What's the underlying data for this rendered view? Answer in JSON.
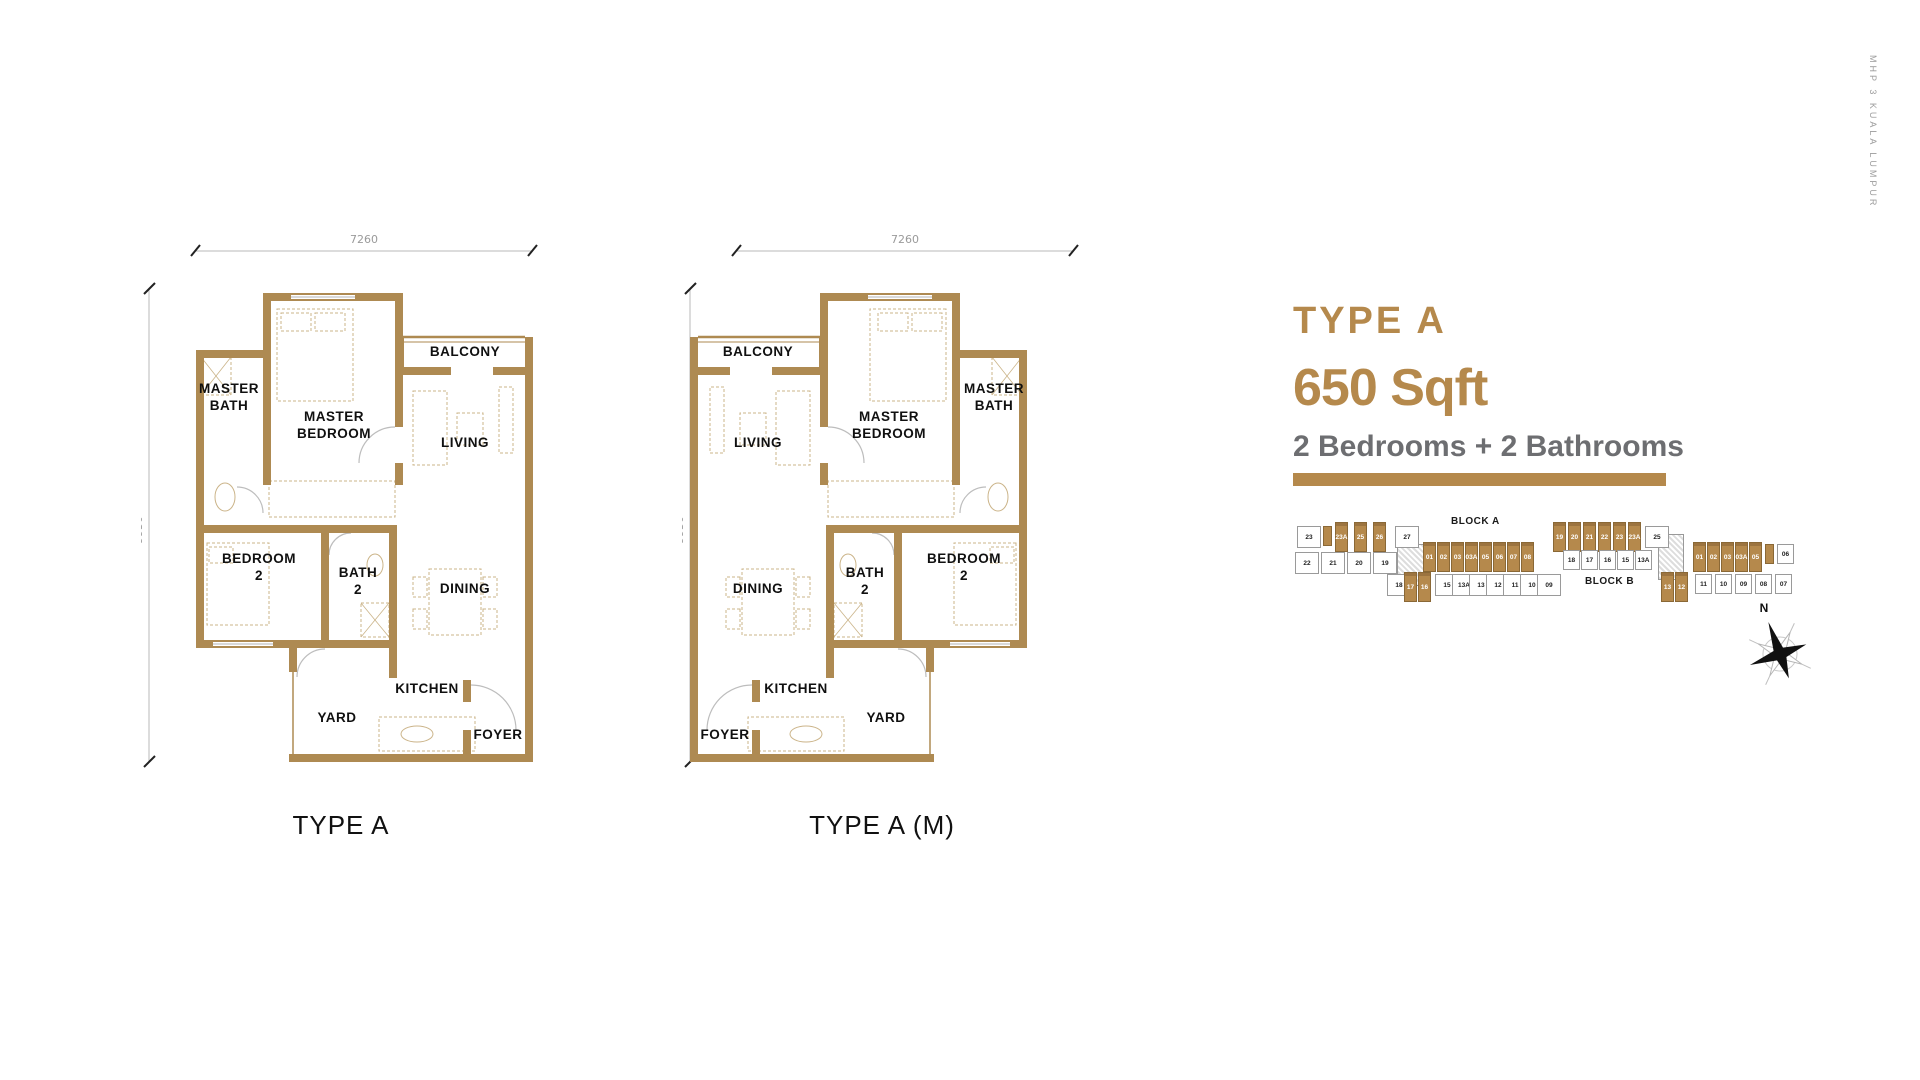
{
  "side_text": "MHP 3 KUALA LUMPUR",
  "info": {
    "title": "TYPE A",
    "size": "650 Sqft",
    "rooms": "2 Bedrooms + 2 Bathrooms",
    "accent_color": "#B5894C",
    "gray_color": "#6D6E71"
  },
  "floorplan": {
    "dim_top": "7260",
    "dim_left": "9950",
    "wall_color": "#AE8A52",
    "furniture_color": "#CBB489",
    "walls": [
      [
        122,
        68,
        140,
        8
      ],
      [
        122,
        68,
        8,
        192
      ],
      [
        254,
        68,
        8,
        134
      ],
      [
        254,
        238,
        8,
        22
      ],
      [
        55,
        125,
        75,
        8
      ],
      [
        55,
        125,
        8,
        183
      ],
      [
        55,
        300,
        133,
        8
      ],
      [
        55,
        308,
        8,
        107
      ],
      [
        55,
        415,
        133,
        8
      ],
      [
        180,
        300,
        8,
        123
      ],
      [
        188,
        300,
        68,
        8
      ],
      [
        248,
        300,
        8,
        123
      ],
      [
        180,
        415,
        76,
        8
      ],
      [
        262,
        142,
        48,
        8
      ],
      [
        352,
        142,
        40,
        8
      ],
      [
        384,
        112,
        8,
        425
      ],
      [
        148,
        529,
        244,
        8
      ],
      [
        148,
        415,
        8,
        32
      ],
      [
        322,
        455,
        8,
        22
      ],
      [
        322,
        505,
        8,
        32
      ],
      [
        248,
        415,
        8,
        38
      ]
    ],
    "windows": [
      [
        150,
        70,
        64,
        4
      ],
      [
        72,
        417,
        60,
        4
      ]
    ],
    "thin_lines": [
      [
        262,
        112,
        384,
        112,
        2.5
      ],
      [
        262,
        117,
        384,
        117,
        1
      ],
      [
        262,
        112,
        262,
        142,
        2
      ],
      [
        152,
        419,
        152,
        529,
        1.5
      ]
    ],
    "arcs": [
      "M 254 202 A 36 36 0 0 0 218 238",
      "M 330 460 A 45 45 0 0 1 375 505",
      "M 188 330 A 22 22 0 0 1 210 308",
      "M 122 288 A 26 26 0 0 0 96 262",
      "M 156 452 A 28 28 0 0 1 184 424"
    ],
    "furniture_rects": [
      [
        136,
        84,
        76,
        92
      ],
      [
        140,
        88,
        30,
        18
      ],
      [
        174,
        88,
        30,
        18
      ],
      [
        128,
        256,
        126,
        36
      ],
      [
        66,
        318,
        62,
        82
      ],
      [
        68,
        322,
        24,
        16
      ],
      [
        288,
        344,
        52,
        66
      ],
      [
        272,
        352,
        14,
        20
      ],
      [
        342,
        352,
        14,
        20
      ],
      [
        272,
        384,
        14,
        20
      ],
      [
        342,
        384,
        14,
        20
      ],
      [
        272,
        166,
        34,
        74
      ],
      [
        316,
        188,
        26,
        32
      ],
      [
        358,
        162,
        14,
        66
      ],
      [
        238,
        492,
        96,
        34
      ],
      [
        60,
        132,
        30,
        38
      ],
      [
        220,
        378,
        28,
        34
      ]
    ],
    "furniture_ellipses": [
      [
        84,
        272,
        10,
        14
      ],
      [
        234,
        340,
        8,
        11
      ],
      [
        276,
        509,
        16,
        8
      ]
    ],
    "cross_boxes": [
      [
        60,
        132,
        30,
        38
      ],
      [
        220,
        378,
        28,
        34
      ]
    ],
    "plans": [
      {
        "caption": "TYPE A",
        "mirror": false,
        "labels": [
          {
            "lines": [
              "MASTER",
              "BATH"
            ],
            "x": 88,
            "y": 168
          },
          {
            "lines": [
              "MASTER",
              "BEDROOM"
            ],
            "x": 193,
            "y": 196
          },
          {
            "lines": [
              "BALCONY"
            ],
            "x": 324,
            "y": 131
          },
          {
            "lines": [
              "LIVING"
            ],
            "x": 324,
            "y": 222
          },
          {
            "lines": [
              "BEDROOM",
              "2"
            ],
            "x": 118,
            "y": 338
          },
          {
            "lines": [
              "BATH",
              "2"
            ],
            "x": 217,
            "y": 352
          },
          {
            "lines": [
              "DINING"
            ],
            "x": 324,
            "y": 368
          },
          {
            "lines": [
              "YARD"
            ],
            "x": 196,
            "y": 497
          },
          {
            "lines": [
              "KITCHEN"
            ],
            "x": 286,
            "y": 468
          },
          {
            "lines": [
              "FOYER"
            ],
            "x": 357,
            "y": 514
          }
        ]
      },
      {
        "caption": "TYPE A (M)",
        "mirror": true,
        "labels": [
          {
            "lines": [
              "MASTER",
              "BATH"
            ],
            "x": 312,
            "y": 168
          },
          {
            "lines": [
              "MASTER",
              "BEDROOM"
            ],
            "x": 207,
            "y": 196
          },
          {
            "lines": [
              "BALCONY"
            ],
            "x": 76,
            "y": 131
          },
          {
            "lines": [
              "LIVING"
            ],
            "x": 76,
            "y": 222
          },
          {
            "lines": [
              "BEDROOM",
              "2"
            ],
            "x": 282,
            "y": 338
          },
          {
            "lines": [
              "BATH",
              "2"
            ],
            "x": 183,
            "y": 352
          },
          {
            "lines": [
              "DINING"
            ],
            "x": 76,
            "y": 368
          },
          {
            "lines": [
              "YARD"
            ],
            "x": 204,
            "y": 497
          },
          {
            "lines": [
              "KITCHEN"
            ],
            "x": 114,
            "y": 468
          },
          {
            "lines": [
              "FOYER"
            ],
            "x": 43,
            "y": 514
          }
        ]
      }
    ]
  },
  "siteplan": {
    "block_a_label": "BLOCK A",
    "block_b_label": "BLOCK B",
    "gold": "#B5894C",
    "cores": [
      [
        102,
        30,
        28,
        42
      ],
      [
        363,
        20,
        26,
        46
      ]
    ],
    "units": [
      {
        "t": "23",
        "x": 2,
        "y": 12,
        "v": "w"
      },
      {
        "t": "",
        "x": 28,
        "y": 12,
        "v": "gs"
      },
      {
        "t": "23A",
        "x": 40,
        "y": 8,
        "v": "g"
      },
      {
        "t": "25",
        "x": 59,
        "y": 8,
        "v": "g"
      },
      {
        "t": "26",
        "x": 78,
        "y": 8,
        "v": "g"
      },
      {
        "t": "27",
        "x": 100,
        "y": 12,
        "v": "w"
      },
      {
        "t": "22",
        "x": 0,
        "y": 38,
        "v": "w"
      },
      {
        "t": "21",
        "x": 26,
        "y": 38,
        "v": "w"
      },
      {
        "t": "20",
        "x": 52,
        "y": 38,
        "v": "w"
      },
      {
        "t": "19",
        "x": 78,
        "y": 38,
        "v": "w"
      },
      {
        "t": "01",
        "x": 128,
        "y": 28,
        "v": "g"
      },
      {
        "t": "02",
        "x": 142,
        "y": 28,
        "v": "g"
      },
      {
        "t": "03",
        "x": 156,
        "y": 28,
        "v": "g"
      },
      {
        "t": "03A",
        "x": 170,
        "y": 28,
        "v": "g"
      },
      {
        "t": "05",
        "x": 184,
        "y": 28,
        "v": "g"
      },
      {
        "t": "06",
        "x": 198,
        "y": 28,
        "v": "g"
      },
      {
        "t": "07",
        "x": 212,
        "y": 28,
        "v": "g"
      },
      {
        "t": "08",
        "x": 226,
        "y": 28,
        "v": "g"
      },
      {
        "t": "18",
        "x": 92,
        "y": 60,
        "v": "w"
      },
      {
        "t": "17",
        "x": 109,
        "y": 58,
        "v": "g"
      },
      {
        "t": "16",
        "x": 123,
        "y": 58,
        "v": "g"
      },
      {
        "t": "15",
        "x": 140,
        "y": 60,
        "v": "w"
      },
      {
        "t": "13A",
        "x": 157,
        "y": 60,
        "v": "w"
      },
      {
        "t": "13",
        "x": 174,
        "y": 60,
        "v": "w"
      },
      {
        "t": "12",
        "x": 191,
        "y": 60,
        "v": "w"
      },
      {
        "t": "11",
        "x": 208,
        "y": 60,
        "v": "w"
      },
      {
        "t": "10",
        "x": 225,
        "y": 60,
        "v": "w"
      },
      {
        "t": "09",
        "x": 242,
        "y": 60,
        "v": "w"
      },
      {
        "t": "19",
        "x": 258,
        "y": 8,
        "v": "g"
      },
      {
        "t": "20",
        "x": 273,
        "y": 8,
        "v": "g"
      },
      {
        "t": "21",
        "x": 288,
        "y": 8,
        "v": "g"
      },
      {
        "t": "22",
        "x": 303,
        "y": 8,
        "v": "g"
      },
      {
        "t": "23",
        "x": 318,
        "y": 8,
        "v": "g"
      },
      {
        "t": "23A",
        "x": 333,
        "y": 8,
        "v": "g"
      },
      {
        "t": "25",
        "x": 350,
        "y": 12,
        "v": "w"
      },
      {
        "t": "18",
        "x": 268,
        "y": 36,
        "v": "w2"
      },
      {
        "t": "17",
        "x": 286,
        "y": 36,
        "v": "w2"
      },
      {
        "t": "16",
        "x": 304,
        "y": 36,
        "v": "w2"
      },
      {
        "t": "15",
        "x": 322,
        "y": 36,
        "v": "w2"
      },
      {
        "t": "13A",
        "x": 340,
        "y": 36,
        "v": "w2"
      },
      {
        "t": "01",
        "x": 398,
        "y": 28,
        "v": "g"
      },
      {
        "t": "02",
        "x": 412,
        "y": 28,
        "v": "g"
      },
      {
        "t": "03",
        "x": 426,
        "y": 28,
        "v": "g"
      },
      {
        "t": "03A",
        "x": 440,
        "y": 28,
        "v": "g"
      },
      {
        "t": "05",
        "x": 454,
        "y": 28,
        "v": "g"
      },
      {
        "t": "",
        "x": 470,
        "y": 30,
        "v": "gs"
      },
      {
        "t": "06",
        "x": 482,
        "y": 30,
        "v": "w2"
      },
      {
        "t": "13",
        "x": 366,
        "y": 58,
        "v": "g"
      },
      {
        "t": "12",
        "x": 380,
        "y": 58,
        "v": "g"
      },
      {
        "t": "11",
        "x": 400,
        "y": 60,
        "v": "w2"
      },
      {
        "t": "10",
        "x": 420,
        "y": 60,
        "v": "w2"
      },
      {
        "t": "09",
        "x": 440,
        "y": 60,
        "v": "w2"
      },
      {
        "t": "08",
        "x": 460,
        "y": 60,
        "v": "w2"
      },
      {
        "t": "07",
        "x": 480,
        "y": 60,
        "v": "w2"
      }
    ],
    "compass_label": "N"
  }
}
